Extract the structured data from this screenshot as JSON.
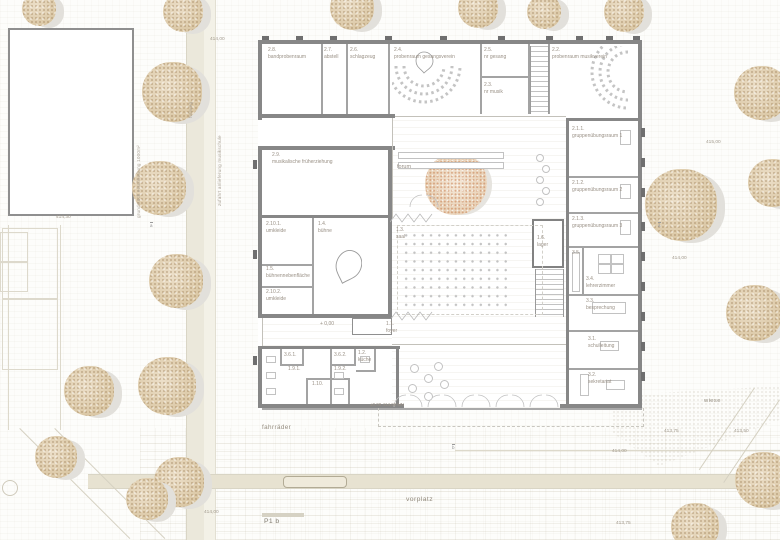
{
  "site": {
    "labels": {
      "forum": "forum",
      "fahrraeder": "fahrräder",
      "vorplatz": "vorplatz",
      "wiese": "wiese",
      "plan_ref": "P1 b",
      "footpath": "fußweg",
      "annotation_plot": "grundstück erschließung 1000m²",
      "annotation_delivery": "zufahrt anlieferung musikschule"
    },
    "elevations": {
      "top": "414,00",
      "left": "414,30",
      "right_upper": "415,00",
      "right_mid": "414,00",
      "bottom_right_a": "413,75",
      "bottom_right_b": "413,50",
      "bottom_mid": "414,00",
      "bottom_left": "414,00",
      "bottom_far_right": "413,75"
    },
    "section_markers": {
      "left": "a",
      "right": "a",
      "south": "b"
    }
  },
  "building": {
    "levels": {
      "foyer_zero": "+ 0,00",
      "entrance_nn": "±0,00 414,00 NN"
    },
    "rooms": [
      {
        "id": "2.8.",
        "name": "bandprobenraum"
      },
      {
        "id": "2.7.",
        "name": "abstell"
      },
      {
        "id": "2.6.",
        "name": "schlagzeug"
      },
      {
        "id": "2.4.",
        "name": "probenraum gesangsverein"
      },
      {
        "id": "2.5.",
        "name": "nr gesang"
      },
      {
        "id": "2.3.",
        "name": "nr musik"
      },
      {
        "id": "2.2.",
        "name": "probenraum musikverein"
      },
      {
        "id": "2.1.1.",
        "name": "gruppenübungsraum 1"
      },
      {
        "id": "2.1.2.",
        "name": "gruppenübungsraum 2"
      },
      {
        "id": "2.1.3.",
        "name": "gruppenübungsraum 3"
      },
      {
        "id": "3.5.",
        "name": ""
      },
      {
        "id": "3.4.",
        "name": "lehrerzimmer"
      },
      {
        "id": "3.3.",
        "name": "besprechung"
      },
      {
        "id": "3.1.",
        "name": "schulleitung"
      },
      {
        "id": "3.2.",
        "name": "sekretariat"
      },
      {
        "id": "2.9.",
        "name": "musikalische früherziehung"
      },
      {
        "id": "2.10.1.",
        "name": "umkleide"
      },
      {
        "id": "1.4.",
        "name": "bühne"
      },
      {
        "id": "1.5.",
        "name": "bühnennebenfläche"
      },
      {
        "id": "2.10.2.",
        "name": "umkleide"
      },
      {
        "id": "1.3.",
        "name": "saal"
      },
      {
        "id": "1.6.",
        "name": "lager"
      },
      {
        "id": "1.1.",
        "name": "foyer"
      },
      {
        "id": "3.6.1.",
        "name": ""
      },
      {
        "id": "1.9.1.",
        "name": ""
      },
      {
        "id": "3.6.2.",
        "name": ""
      },
      {
        "id": "1.2.",
        "name": "küche"
      },
      {
        "id": "1.10.",
        "name": ""
      },
      {
        "id": "1.9.2.",
        "name": ""
      }
    ]
  }
}
